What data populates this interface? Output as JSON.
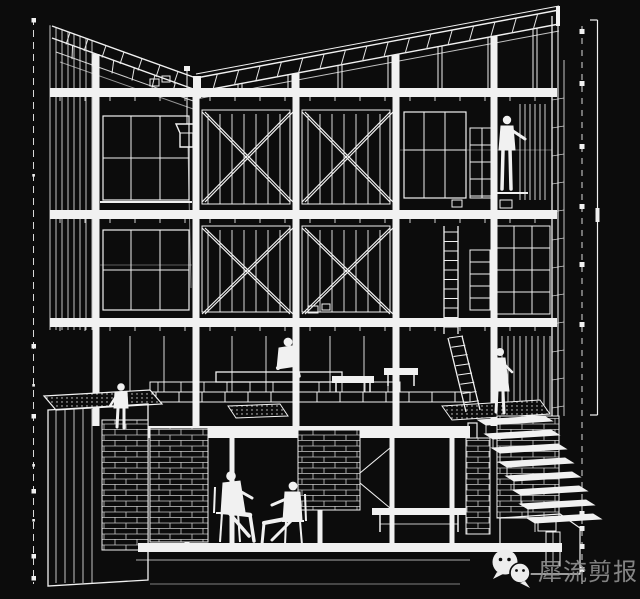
{
  "canvas": {
    "width": 640,
    "height": 599,
    "background": "#0c0c0c",
    "line_color": "#f1f1f1"
  },
  "artwork": {
    "kind": "architectural sectional perspective drawing",
    "style": "white wireframe linework on black",
    "levels": [
      "roof truss",
      "upper story",
      "middle story",
      "ground deck",
      "basement"
    ],
    "figure_count": 6
  },
  "watermark": {
    "text": "犀流剪报",
    "color": "#8f8f8f",
    "icon": "wechat-icon",
    "icon_color": "#ededed"
  }
}
